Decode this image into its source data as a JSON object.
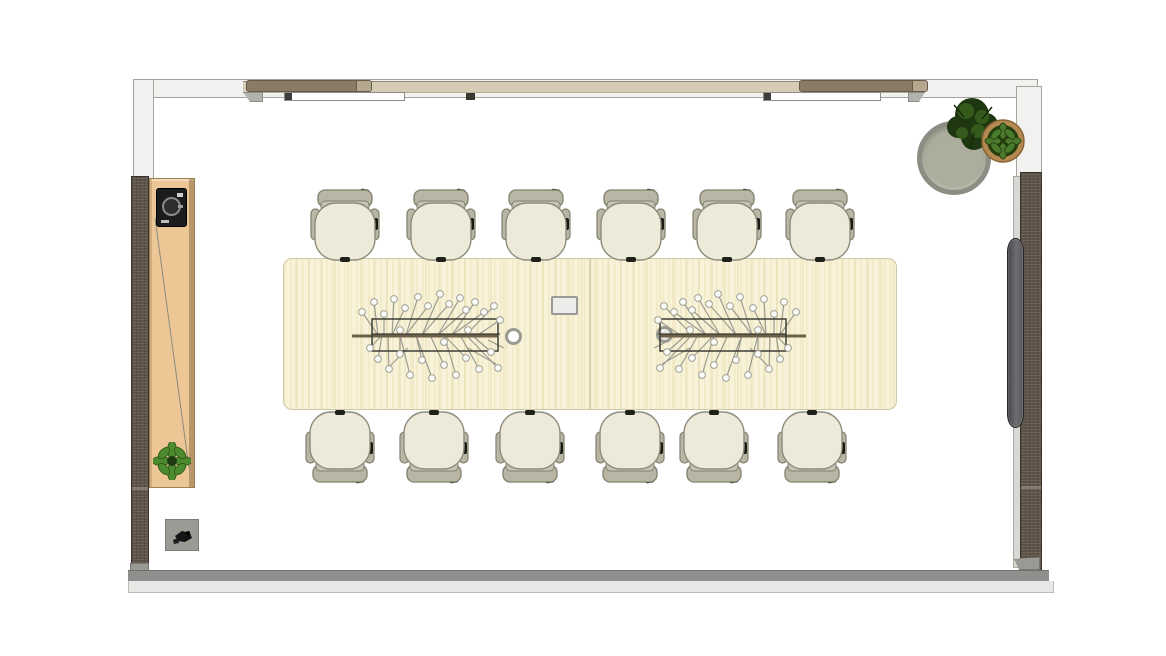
{
  "meta": {
    "kind": "architectural floor plan",
    "view": "top-down",
    "room": "conference room",
    "visible_text": "none"
  },
  "palette": {
    "bg": "#ffffff",
    "wall_face": "#f1f1ef",
    "wall_line": "#a5a5a0",
    "wall_beige": "#d6ccb6",
    "wall_beige_edge": "#8f8673",
    "track_brown": "#8a7b65",
    "door_white": "#fdfdfd",
    "panel_dark": "#5d5348",
    "panel_line": "#38332b",
    "cabinet_tan": "#ecc795",
    "cabinet_edge": "#9c8153",
    "table_cream": "#f8f3d8",
    "table_edge": "#cfc8a5",
    "chair_seat": "#edead9",
    "chair_back": "#b9b6a5",
    "chair_line": "#80806c",
    "bottom_wall": "#8f8f8d",
    "bottom_wall_light": "#e7e7e5",
    "tv_gray": "#54545a",
    "side_table_rim": "#8d8d83",
    "side_table_top": "#adad9d",
    "plant_green": "#4c8a2e",
    "plant_dark": "#24400f",
    "pot_brown": "#b58a52",
    "rod_brown": "#6f6049",
    "metal_gray": "#9b9b91"
  },
  "furniture": {
    "conference_table": {
      "name": "conference table",
      "modules": 2,
      "grommets": 2,
      "control_panel": 1
    },
    "chairs": {
      "name": "task chair",
      "total": 12,
      "rows": {
        "top": 6,
        "bottom": 6
      }
    },
    "chandeliers": {
      "name": "branch chandelier",
      "count": 2
    },
    "credenza": {
      "name": "credenza",
      "items_on_top": [
        "audio-device",
        "plant"
      ]
    },
    "side_table": {
      "name": "round side table",
      "count": 1
    },
    "plants": {
      "count": 3
    },
    "tv": {
      "name": "wall-mounted display",
      "count": 1
    },
    "sliding_doors": {
      "count": 2
    },
    "floor_box": {
      "count": 1
    }
  }
}
